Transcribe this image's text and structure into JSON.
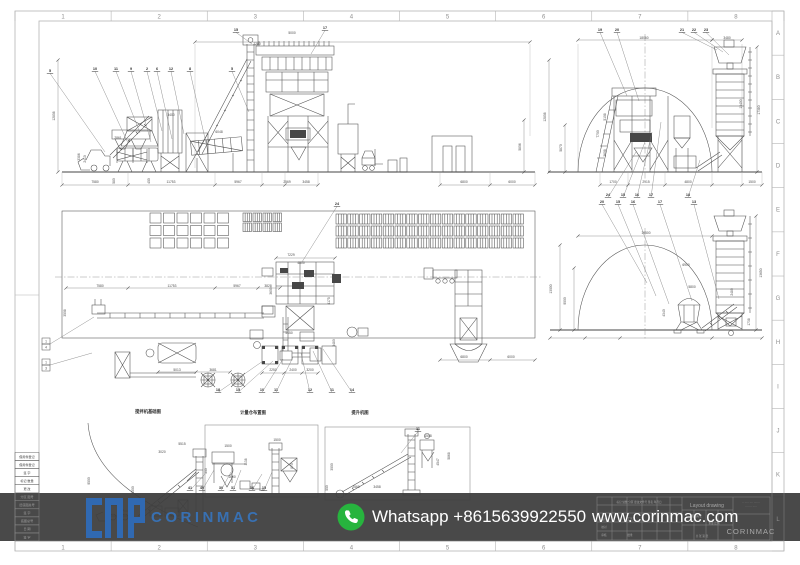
{
  "sheet": {
    "h_index": [
      "1",
      "2",
      "3",
      "4",
      "5",
      "6",
      "7",
      "8"
    ],
    "v_index": [
      "A",
      "B",
      "C",
      "D",
      "E",
      "F",
      "G",
      "H",
      "I",
      "J",
      "K",
      "L"
    ]
  },
  "banner": {
    "whatsapp": "Whatsapp +8615639922550",
    "website": "www.corinmac.com",
    "logo_text": "CORINMAC",
    "bar_color": "#3e3e3e",
    "whatsapp_green": "#27b43e",
    "logo_blue": "#3873b8"
  },
  "title_block": {
    "title": "Layout drawing",
    "company": "CORINMAC",
    "note_lines": [
      "·· ····· ···· ·······",
      "··· ···· ·····"
    ],
    "cells": [
      {
        "t": "标记 处数 分区 更改文件号 签名 年月日",
        "x": 639,
        "y": 503
      },
      {
        "t": "设计",
        "x": 604,
        "y": 520
      },
      {
        "t": "校对",
        "x": 604,
        "y": 528
      },
      {
        "t": "审核",
        "x": 604,
        "y": 536
      },
      {
        "t": "工艺",
        "x": 630,
        "y": 520
      },
      {
        "t": "批准",
        "x": 630,
        "y": 536
      },
      {
        "t": "阶段标记",
        "x": 697,
        "y": 517
      },
      {
        "t": "重量 比例",
        "x": 714,
        "y": 524
      },
      {
        "t": "共 张 第 张",
        "x": 702,
        "y": 537
      }
    ]
  },
  "revision_strip": [
    "借用件登记",
    "借用件登记",
    "签 字",
    "标记 数量",
    "更 改",
    "分区 图号",
    "旧底图总号",
    "签 字",
    "底图总号",
    "日 期",
    "签 字"
  ],
  "captions": [
    {
      "t": "搅拌机基础图",
      "x": 148,
      "y": 413
    },
    {
      "t": "计量仓布置图",
      "x": 253,
      "y": 414
    },
    {
      "t": "提升机图",
      "x": 360,
      "y": 414
    }
  ],
  "dims": [
    [
      "12808",
      55,
      116,
      1
    ],
    [
      "3386",
      80,
      157,
      1
    ],
    [
      "2410",
      86,
      159,
      1
    ],
    [
      "580",
      115,
      181,
      1
    ],
    [
      "450",
      150,
      181,
      1
    ],
    [
      "2861",
      118,
      139,
      0
    ],
    [
      "3400",
      171,
      116,
      0
    ],
    [
      "6048",
      219,
      133,
      0
    ],
    [
      "2280",
      257,
      45,
      0
    ],
    [
      "5000",
      292,
      34,
      0
    ],
    [
      "5806",
      521,
      147,
      1
    ],
    [
      "7580",
      95,
      183,
      0
    ],
    [
      "11753",
      171,
      183,
      0
    ],
    [
      "5967",
      238,
      183,
      0
    ],
    [
      "2569",
      287,
      183,
      0
    ],
    [
      "3458",
      306,
      183,
      0
    ],
    [
      "6800",
      464,
      183,
      0
    ],
    [
      "6000",
      512,
      183,
      0
    ],
    [
      "18060",
      644,
      39,
      0
    ],
    [
      "3480",
      727,
      39,
      0
    ],
    [
      "12808",
      546,
      117,
      1
    ],
    [
      "5870",
      562,
      148,
      1
    ],
    [
      "7700",
      599,
      134,
      1
    ],
    [
      "5108",
      606,
      117,
      1
    ],
    [
      "3608",
      606,
      153,
      1
    ],
    [
      "17380",
      760,
      110,
      1
    ],
    [
      "13400",
      742,
      104,
      1
    ],
    [
      "1700",
      613,
      183,
      0
    ],
    [
      "2915",
      646,
      183,
      0
    ],
    [
      "4800",
      688,
      183,
      0
    ],
    [
      "1500",
      752,
      183,
      0
    ],
    [
      "7580",
      100,
      287,
      0
    ],
    [
      "11753",
      172,
      287,
      0
    ],
    [
      "5967",
      237,
      287,
      0
    ],
    [
      "3828",
      268,
      287,
      0
    ],
    [
      "7229",
      291,
      256,
      0
    ],
    [
      "4800",
      301,
      264,
      0
    ],
    [
      "3600",
      272,
      291,
      1
    ],
    [
      "4175",
      330,
      301,
      1
    ],
    [
      "3480",
      335,
      343,
      1
    ],
    [
      "5450",
      289,
      334,
      0
    ],
    [
      "5013",
      177,
      371,
      0
    ],
    [
      "3681",
      213,
      371,
      0
    ],
    [
      "2250",
      273,
      371,
      0
    ],
    [
      "2400",
      293,
      371,
      0
    ],
    [
      "3200",
      310,
      371,
      0
    ],
    [
      "6800",
      464,
      358,
      0
    ],
    [
      "6000",
      511,
      358,
      0
    ],
    [
      "3508",
      66,
      313,
      1
    ],
    [
      "19500",
      646,
      234,
      0
    ],
    [
      "13000",
      552,
      289,
      1
    ],
    [
      "9000",
      566,
      301,
      1
    ],
    [
      "6900",
      686,
      266,
      0
    ],
    [
      "5800",
      692,
      288,
      0
    ],
    [
      "4340",
      665,
      313,
      1
    ],
    [
      "2480",
      733,
      292,
      1
    ],
    [
      "13650",
      762,
      273,
      1
    ],
    [
      "1738",
      750,
      322,
      1
    ],
    [
      "9500",
      90,
      481,
      1
    ],
    [
      "3020",
      162,
      453,
      0
    ],
    [
      "5515",
      182,
      445,
      0
    ],
    [
      "3500",
      134,
      490,
      1
    ],
    [
      "1500",
      228,
      447,
      0
    ],
    [
      "1138",
      247,
      462,
      1
    ],
    [
      "1500",
      277,
      441,
      0
    ],
    [
      "870",
      293,
      466,
      1
    ],
    [
      "1600",
      232,
      478,
      0
    ],
    [
      "500",
      207,
      471,
      1
    ],
    [
      "631",
      262,
      491,
      0
    ],
    [
      "3000",
      333,
      467,
      1
    ],
    [
      "2569",
      356,
      488,
      0
    ],
    [
      "3458",
      377,
      488,
      0
    ],
    [
      "4547",
      439,
      462,
      1
    ],
    [
      "5868",
      450,
      456,
      1
    ],
    [
      "1508",
      428,
      437,
      0
    ],
    [
      "550",
      328,
      488,
      1
    ]
  ],
  "dimlines": [
    [
      62,
      185,
      318,
      185,
      [
        62,
        128,
        215,
        262,
        285,
        318
      ]
    ],
    [
      440,
      185,
      535,
      185,
      [
        440,
        490,
        535
      ]
    ],
    [
      195,
      42,
      530,
      42,
      [
        195,
        530
      ]
    ],
    [
      58,
      60,
      58,
      172,
      [
        60,
        172
      ]
    ],
    [
      524,
      120,
      524,
      172,
      [
        120,
        172
      ]
    ],
    [
      578,
      40,
      712,
      40,
      [
        578,
        712
      ]
    ],
    [
      712,
      40,
      742,
      40,
      [
        712,
        742
      ]
    ],
    [
      549,
      60,
      549,
      172,
      [
        60,
        172
      ]
    ],
    [
      565,
      125,
      565,
      172,
      [
        125,
        172
      ]
    ],
    [
      757,
      47,
      757,
      172,
      [
        47,
        172
      ]
    ],
    [
      600,
      185,
      762,
      185,
      [
        600,
        628,
        665,
        712,
        742,
        762
      ]
    ],
    [
      66,
      288,
      280,
      288,
      [
        66,
        128,
        215,
        258,
        280
      ]
    ],
    [
      276,
      258,
      335,
      258,
      [
        276,
        335
      ]
    ],
    [
      440,
      360,
      535,
      360,
      [
        440,
        490,
        535
      ]
    ],
    [
      158,
      372,
      230,
      372,
      [
        158,
        196,
        230
      ]
    ],
    [
      262,
      373,
      318,
      373,
      [
        262,
        284,
        302,
        318
      ]
    ],
    [
      578,
      236,
      712,
      236,
      [
        578,
        712
      ]
    ],
    [
      560,
      245,
      560,
      330,
      [
        245,
        330
      ]
    ],
    [
      574,
      268,
      574,
      330,
      [
        268,
        330
      ]
    ],
    [
      756,
      216,
      756,
      330,
      [
        216,
        330
      ]
    ],
    [
      550,
      338,
      762,
      338,
      [
        550,
        585,
        620,
        712,
        762
      ]
    ]
  ],
  "callouts": [
    [
      "5",
      50,
      72,
      105,
      152
    ],
    [
      "10",
      95,
      70,
      128,
      143
    ],
    [
      "11",
      116,
      70,
      140,
      133
    ],
    [
      "9",
      131,
      70,
      151,
      142
    ],
    [
      "2",
      147,
      70,
      162,
      131
    ],
    [
      "6",
      157,
      70,
      172,
      139
    ],
    [
      "12",
      171,
      70,
      184,
      134
    ],
    [
      "8",
      190,
      70,
      206,
      143
    ],
    [
      "5",
      232,
      70,
      249,
      112
    ],
    [
      "15",
      236,
      31,
      252,
      44
    ],
    [
      "17",
      325,
      29,
      311,
      54
    ],
    [
      "19",
      600,
      31,
      627,
      96
    ],
    [
      "20",
      617,
      31,
      639,
      101
    ],
    [
      "21",
      682,
      31,
      717,
      50
    ],
    [
      "22",
      694,
      31,
      723,
      52
    ],
    [
      "23",
      706,
      31,
      729,
      55
    ],
    [
      "24",
      608,
      196,
      636,
      152
    ],
    [
      "15",
      623,
      196,
      645,
      142
    ],
    [
      "16",
      637,
      196,
      652,
      132
    ],
    [
      "17",
      651,
      196,
      661,
      122
    ],
    [
      "18",
      688,
      196,
      700,
      160
    ],
    [
      "24",
      337,
      205,
      302,
      262
    ],
    [
      "18",
      218,
      391,
      263,
      361
    ],
    [
      "15",
      238,
      391,
      273,
      361
    ],
    [
      "10",
      262,
      391,
      283,
      359
    ],
    [
      "11",
      276,
      391,
      293,
      357
    ],
    [
      "12",
      310,
      391,
      301,
      353
    ],
    [
      "11",
      332,
      391,
      313,
      351
    ],
    [
      "14",
      352,
      391,
      323,
      349
    ],
    [
      "20",
      602,
      203,
      647,
      283
    ],
    [
      "15",
      618,
      203,
      656,
      296
    ],
    [
      "16",
      633,
      203,
      669,
      304
    ],
    [
      "17",
      660,
      203,
      692,
      301
    ],
    [
      "13",
      694,
      203,
      719,
      299
    ],
    [
      "41",
      190,
      489,
      205,
      474
    ],
    [
      "40",
      202,
      489,
      214,
      470
    ],
    [
      "30",
      221,
      489,
      231,
      472
    ],
    [
      "31",
      233,
      489,
      241,
      470
    ],
    [
      "16",
      252,
      489,
      262,
      474
    ],
    [
      "15",
      264,
      489,
      272,
      472
    ],
    [
      "11",
      418,
      430,
      401,
      453
    ]
  ],
  "section_marks": [
    {
      "n": "1",
      "d": "4",
      "x": 46,
      "y": 344,
      "lx": 94,
      "ly": 317
    },
    {
      "n": "1",
      "d": "3",
      "x": 46,
      "y": 365,
      "lx": 92,
      "ly": 353
    }
  ],
  "grids": [
    [
      150,
      213,
      6,
      3,
      11,
      10,
      2.5,
      2.5,
      0
    ],
    [
      243,
      213,
      2,
      2,
      8.5,
      8.5,
      1.5,
      1.5,
      1
    ],
    [
      263,
      213,
      2,
      2,
      8.5,
      8.5,
      1.5,
      1.5,
      1
    ],
    [
      336,
      214,
      16,
      3,
      10.4,
      10,
      1.4,
      2,
      1
    ]
  ]
}
